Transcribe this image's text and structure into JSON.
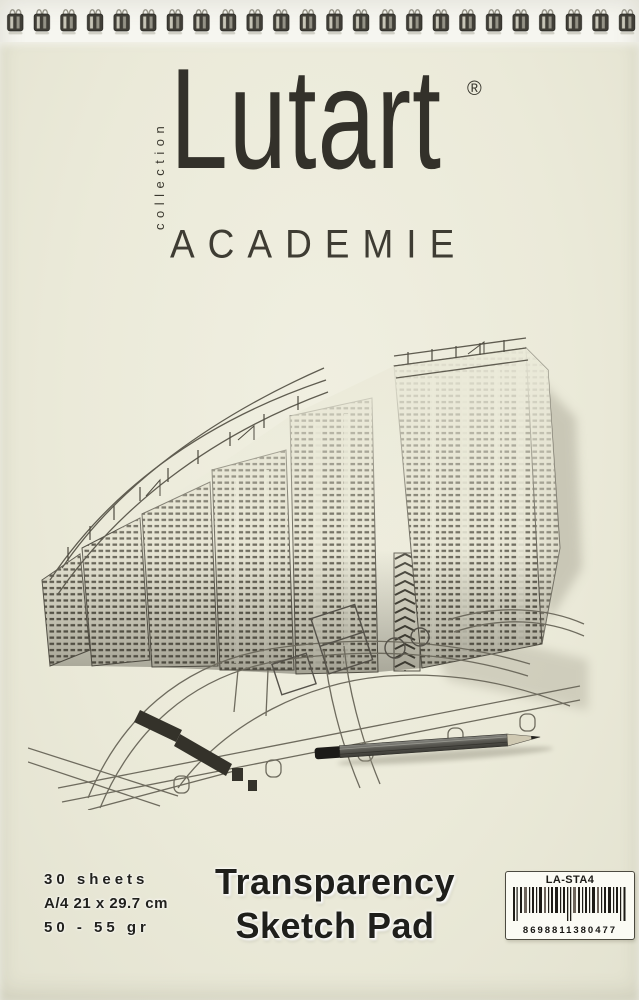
{
  "product": {
    "collection_label": "collection",
    "brand": "Lutart",
    "registered_mark": "®",
    "line_name": "ACADEMIE",
    "title_line1": "Transparency",
    "title_line2": "Sketch Pad",
    "specs": {
      "sheets": "30 sheets",
      "size": "A/4 21 x 29.7 cm",
      "weight": "50 - 55 gr"
    },
    "barcode": {
      "sku": "LA-STA4",
      "number": "8698811380477"
    }
  },
  "binding": {
    "type": "wire spiral binding, top edge",
    "loop_count": 24
  },
  "illustration": {
    "subject": "architectural pen drawing of a curved high-rise apartment complex with site plan roads and a pencil"
  },
  "colors": {
    "cover": "#ebead9",
    "ink": "#33312a",
    "paper_white": "#f6f6f0",
    "label_background": "#fbfbf4"
  }
}
